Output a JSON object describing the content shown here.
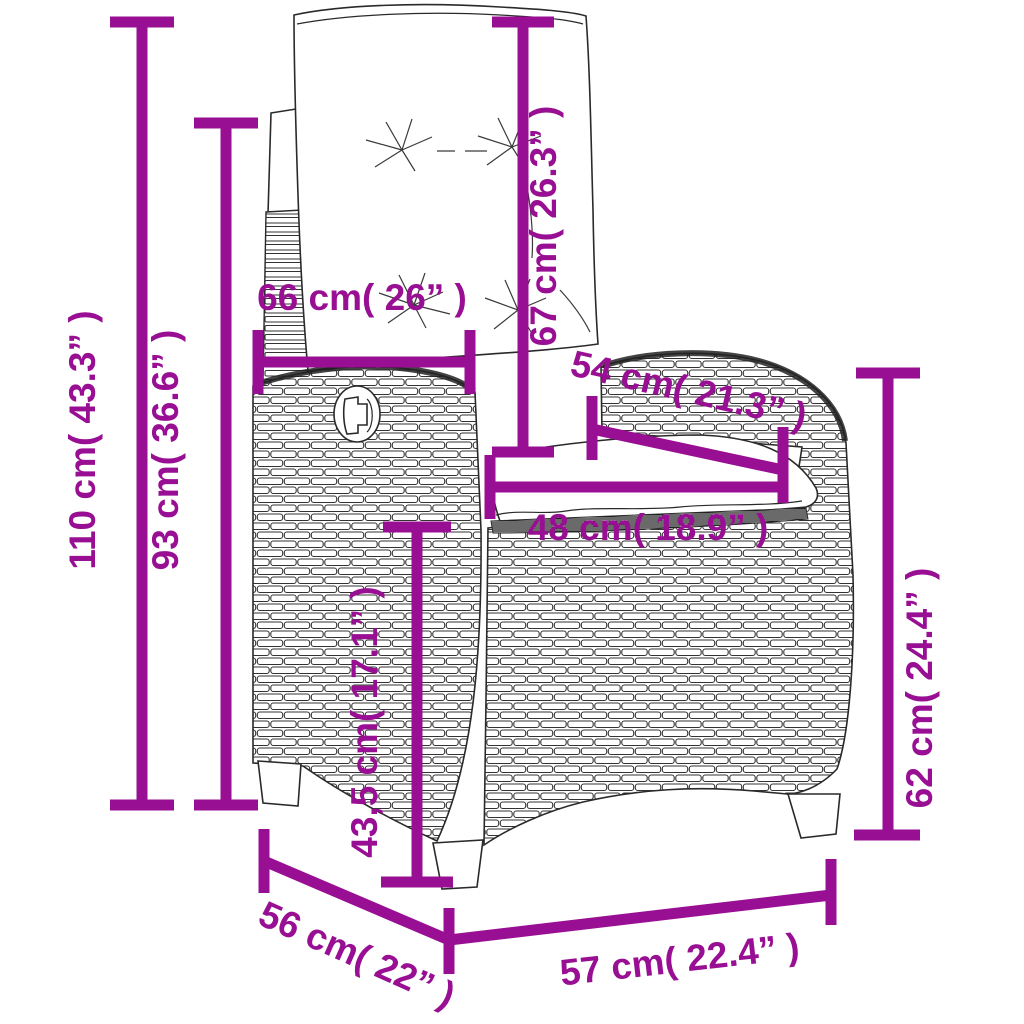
{
  "colors": {
    "accent": "#990F93",
    "background": "#ffffff",
    "line_art": "#2a2a2a"
  },
  "figure": {
    "type": "product-dimension-diagram",
    "subject": "reclining rattan garden chair with cushions"
  },
  "dimensions": [
    {
      "name": "total-height",
      "cm": "110",
      "inches": "43.3",
      "label": "110 cm( 43.3” )"
    },
    {
      "name": "backrest-height",
      "cm": "93",
      "inches": "36.6",
      "label": "93 cm( 36.6” )"
    },
    {
      "name": "backrest-width",
      "cm": "66",
      "inches": "26",
      "label": "66 cm( 26” )"
    },
    {
      "name": "back-cushion-length",
      "cm": "67",
      "inches": "26.3",
      "label": "67 cm( 26.3” )"
    },
    {
      "name": "seat-diagonal-depth",
      "cm": "54",
      "inches": "21.3",
      "label": "54 cm( 21.3” )"
    },
    {
      "name": "seat-width",
      "cm": "48",
      "inches": "18.9",
      "label": "48 cm( 18.9” )"
    },
    {
      "name": "seat-height",
      "cm": "43,5",
      "inches": "17.1",
      "label": "43,5 cm( 17.1” )"
    },
    {
      "name": "armrest-height",
      "cm": "62",
      "inches": "24.4",
      "label": "62 cm( 24.4” )"
    },
    {
      "name": "frame-depth",
      "cm": "56",
      "inches": "22",
      "label": "56 cm( 22” )"
    },
    {
      "name": "frame-width",
      "cm": "57",
      "inches": "22.4",
      "label": "57 cm( 22.4” )"
    }
  ]
}
